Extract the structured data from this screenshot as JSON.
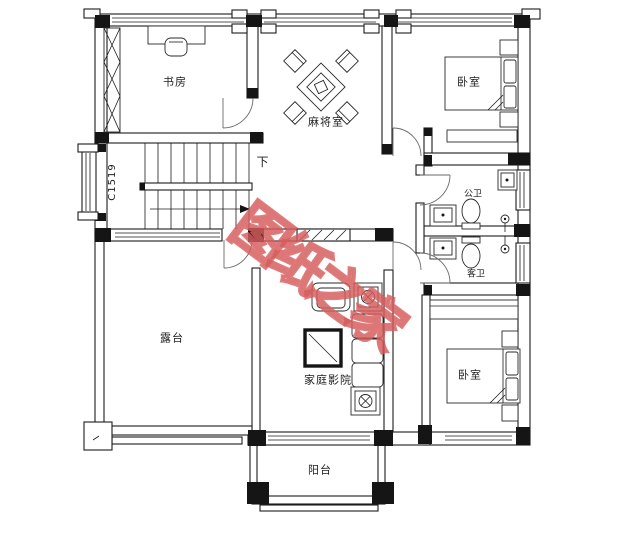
{
  "watermark": {
    "text": "图纸之家",
    "color": "#d65c5c"
  },
  "rooms": {
    "study": "书房",
    "mahjong": "麻将室",
    "bedroom_top": "卧室",
    "bath_public": "公卫",
    "bath_guest": "客卫",
    "bedroom_bottom": "卧室",
    "terrace": "露台",
    "home_theater": "家庭影院",
    "balcony": "阳台"
  },
  "annotations": {
    "stair_direction": "下",
    "window_code": "C1519"
  },
  "colors": {
    "line": "#1c1c1c",
    "background": "#ffffff",
    "watermark": "#d65c5c"
  }
}
